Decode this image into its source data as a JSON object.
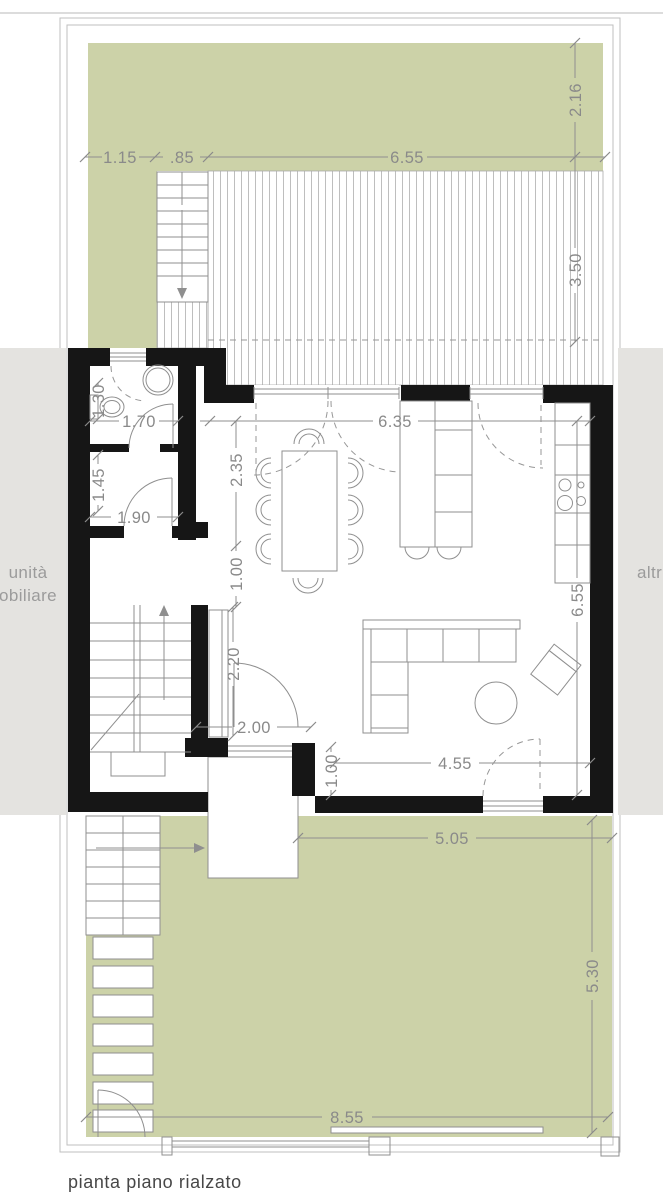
{
  "caption": "pianta piano rialzato",
  "neighbors": {
    "left_line1": "unità",
    "left_line2": "obiliare",
    "right": "altr"
  },
  "dims": {
    "garden_top_a": "1.15",
    "garden_top_b": ".85",
    "garden_top_c": "6.55",
    "garden_top_depth": "2.16",
    "deck_depth": "3.50",
    "living_width": "6.35",
    "bath_fixture": "1.30",
    "bath_width": "1.70",
    "hall_depth": "2.35",
    "ante_depth": "1.45",
    "ante_width": "1.90",
    "hall_opening": "1.00",
    "wardrobe_length": "2.20",
    "entry_width": "2.00",
    "entry_jamb": "1.00",
    "living_front": "4.55",
    "living_depth": "6.55",
    "garden_bottom_front": "5.05",
    "garden_bottom_depth": "5.30",
    "garden_bottom_width": "8.55"
  },
  "colors": {
    "garden_green": "#ccd2a8",
    "neighbor_band_gray": "#e4e3e0",
    "wall_black": "#161616",
    "drawing_line_gray": "#8f8f8f",
    "dimension_text_gray": "#8a8a8a"
  }
}
